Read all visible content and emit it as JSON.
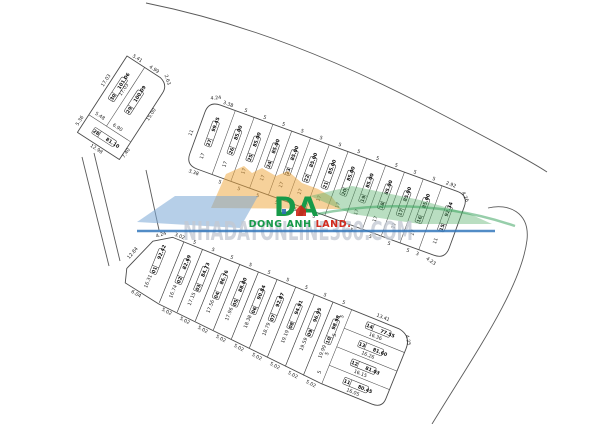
{
  "watermark": {
    "site": "NHADATONLINE360.COM",
    "brand_initials": "DA",
    "brand_green": "DONG ANH",
    "brand_red": " LAND.",
    "colors": {
      "brand_green": "#179a49",
      "brand_red": "#d42b1e",
      "underline_blue": "#3579bd",
      "shape_orange": "#eda63d",
      "shape_blue": "#7aa7d6",
      "shape_green": "#57b06b",
      "site_gray": "#c3c9d3"
    }
  },
  "blocks": {
    "left": {
      "plots": [
        {
          "id": "30",
          "area": "101.06"
        },
        {
          "id": "29",
          "area": "100.09"
        },
        {
          "id": "28",
          "area": "81.10"
        }
      ],
      "dims": [
        "5.41",
        "4.99",
        "2.63",
        "17.03",
        "17.03",
        "15.00",
        "5.48",
        "6.90",
        "5.36",
        "12.98",
        "7.40"
      ]
    },
    "middle": {
      "plots": [
        {
          "id": "27",
          "area": "99.45",
          "depth": "17",
          "top": "",
          "bottom": ""
        },
        {
          "id": "26",
          "area": "85.00",
          "depth": "17",
          "top": "5",
          "bottom": "5"
        },
        {
          "id": "25",
          "area": "85.00",
          "depth": "17",
          "top": "5",
          "bottom": "5"
        },
        {
          "id": "24",
          "area": "85.00",
          "depth": "17",
          "top": "5",
          "bottom": "5"
        },
        {
          "id": "23",
          "area": "85.00",
          "depth": "17",
          "top": "5",
          "bottom": "5"
        },
        {
          "id": "22",
          "area": "85.00",
          "depth": "17",
          "top": "5",
          "bottom": "5"
        },
        {
          "id": "21",
          "area": "85.00",
          "depth": "17",
          "top": "5",
          "bottom": "5"
        },
        {
          "id": "20",
          "area": "85.00",
          "depth": "17",
          "top": "5",
          "bottom": "5"
        },
        {
          "id": "19",
          "area": "85.00",
          "depth": "17",
          "top": "5",
          "bottom": "5"
        },
        {
          "id": "18",
          "area": "85.00",
          "depth": "17",
          "top": "5",
          "bottom": "5"
        },
        {
          "id": "17",
          "area": "85.00",
          "depth": "17",
          "top": "5",
          "bottom": "5"
        },
        {
          "id": "16",
          "area": "85.00",
          "depth": "17",
          "top": "5",
          "bottom": "5"
        },
        {
          "id": "15",
          "area": "92.34",
          "depth": "11",
          "top": "",
          "bottom": ""
        }
      ],
      "dims": [
        "4.24",
        "3.38",
        "11",
        "3.38",
        "2.92",
        "4.26",
        "4.23",
        "3"
      ]
    },
    "bottom": {
      "row_plots": [
        {
          "id": "01",
          "area": "92.42",
          "depth": "16.31",
          "top": "",
          "bottom": ""
        },
        {
          "id": "02",
          "area": "82.69",
          "depth": "16.74",
          "top": "5",
          "bottom": "5.02"
        },
        {
          "id": "03",
          "area": "84.73",
          "depth": "17.15",
          "top": "5",
          "bottom": "5.02"
        },
        {
          "id": "04",
          "area": "86.76",
          "depth": "17.56",
          "top": "5",
          "bottom": "5.02"
        },
        {
          "id": "05",
          "area": "88.80",
          "depth": "17.96",
          "top": "5",
          "bottom": "5.02"
        },
        {
          "id": "06",
          "area": "90.84",
          "depth": "18.38",
          "top": "5",
          "bottom": "5.02"
        },
        {
          "id": "07",
          "area": "92.87",
          "depth": "18.79",
          "top": "5",
          "bottom": "5.02"
        },
        {
          "id": "08",
          "area": "94.91",
          "depth": "19.19",
          "top": "5",
          "bottom": "5.02"
        },
        {
          "id": "09",
          "area": "96.95",
          "depth": "19.59",
          "top": "5",
          "bottom": "5.02"
        },
        {
          "id": "10",
          "area": "98.98",
          "depth": "19.99",
          "top": "5",
          "bottom": "5.02"
        }
      ],
      "stack_plots": [
        {
          "id": "14",
          "area": "77.55",
          "depth": "16.36",
          "side": "5"
        },
        {
          "id": "13",
          "area": "81.60",
          "depth": "16.26",
          "side": "5"
        },
        {
          "id": "12",
          "area": "81.03",
          "depth": "16.15",
          "side": "5"
        },
        {
          "id": "11",
          "area": "80.45",
          "depth": "16.05",
          "side": "5"
        }
      ],
      "dims": [
        "4.24",
        "3.02",
        "12.84",
        "6.04",
        "13.41",
        "4.25"
      ]
    }
  }
}
